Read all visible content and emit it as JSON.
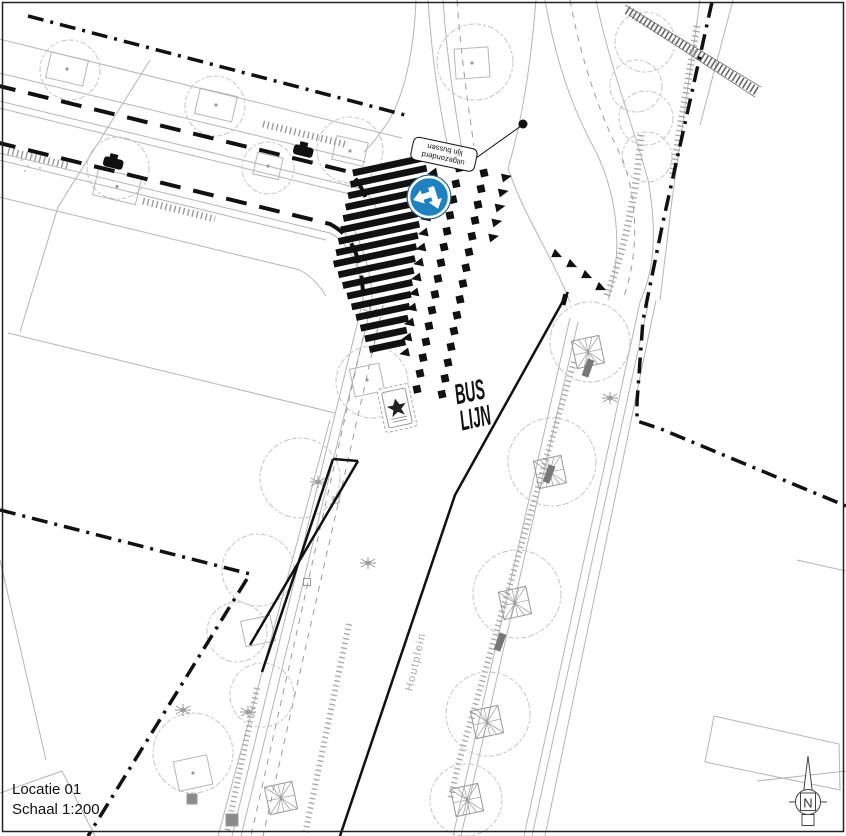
{
  "drawing": {
    "location_label": "Locatie 01",
    "scale_label": "Schaal 1:200",
    "street_name": "Houtplein",
    "sign_annotation": {
      "line1": "uitgezonderd",
      "line2": "lijn bussen"
    },
    "road_marking": {
      "line1": "BUS",
      "line2": "LIJN"
    },
    "north_label": "N"
  },
  "colors": {
    "sign_blue": "#1f82c0",
    "ink": "#111111",
    "gray_line": "#b5b5b5",
    "tick_gray": "#999999",
    "canopy_gray": "#c6c6c6",
    "label_gray": "#aaaaaa"
  },
  "markings": {
    "zebra_bar_count": 17,
    "giveway_teeth_left": 13,
    "giveway_teeth_right_column": 5,
    "giveway_teeth_right_arc": 4,
    "blocks_per_column": 15,
    "block_column_count": 2
  }
}
